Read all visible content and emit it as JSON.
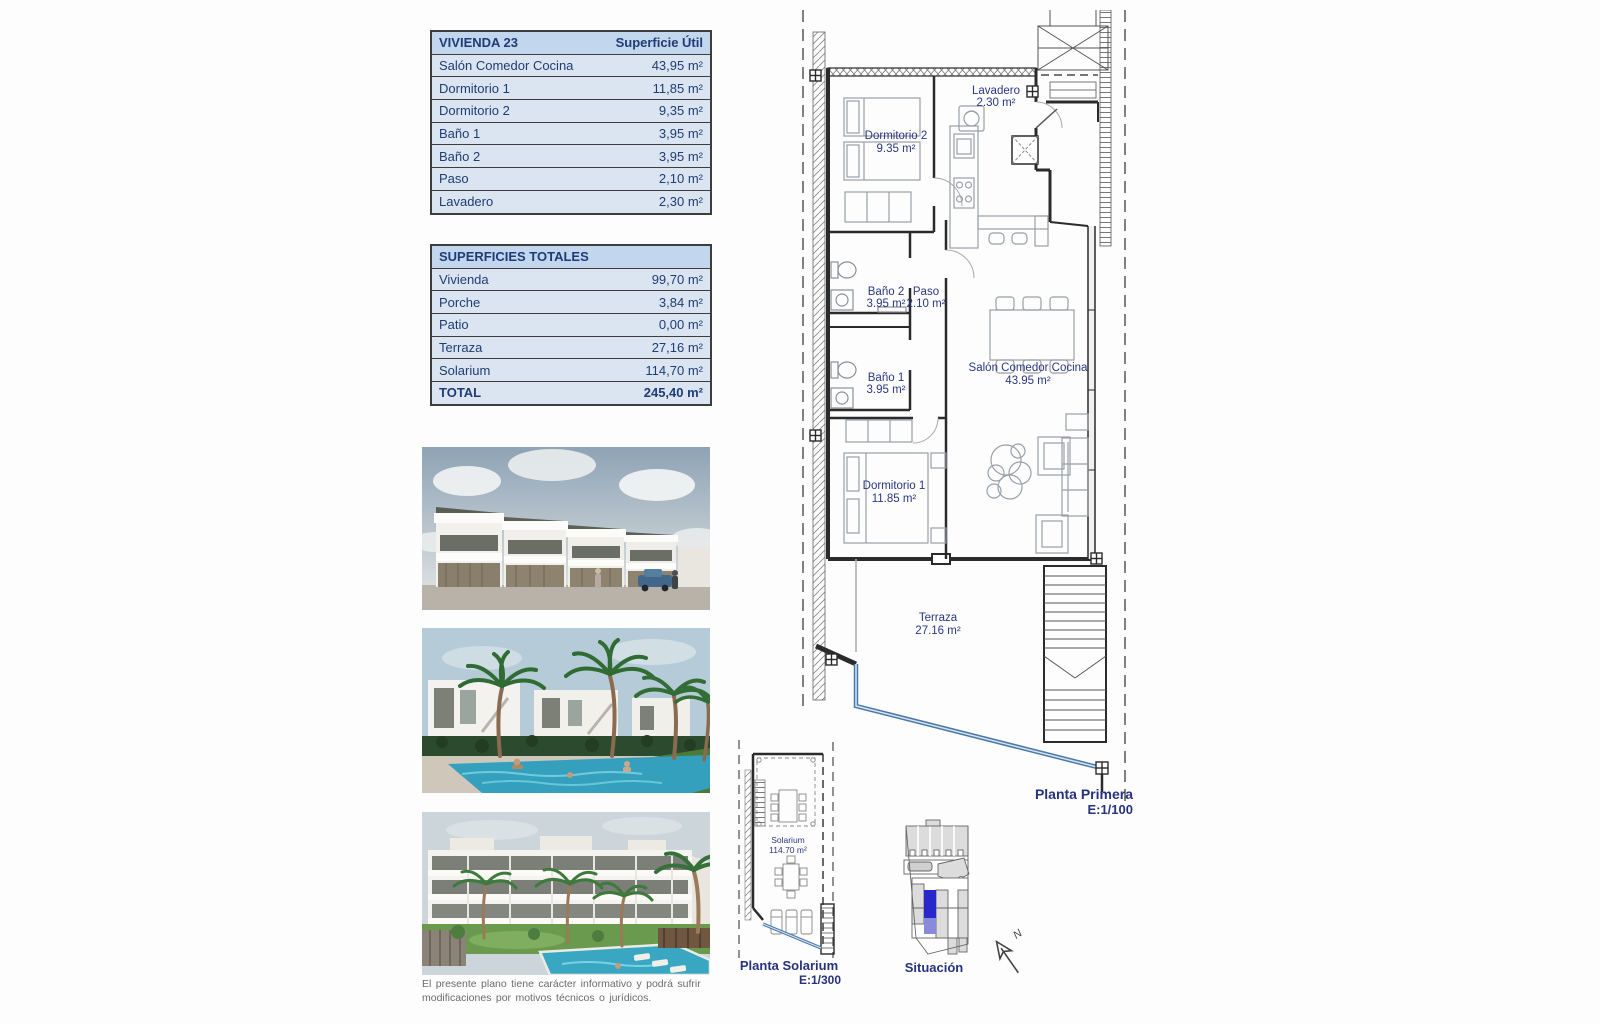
{
  "vivienda_table": {
    "title": "VIVIENDA 23",
    "header_value": "Superficie Útil",
    "rows": [
      {
        "label": "Salón Comedor Cocina",
        "value": "43,95 m²"
      },
      {
        "label": "Dormitorio 1",
        "value": "11,85 m²"
      },
      {
        "label": "Dormitorio 2",
        "value": "9,35 m²"
      },
      {
        "label": "Baño 1",
        "value": "3,95 m²"
      },
      {
        "label": "Baño 2",
        "value": "3,95 m²"
      },
      {
        "label": "Paso",
        "value": "2,10 m²"
      },
      {
        "label": "Lavadero",
        "value": "2,30 m²"
      }
    ]
  },
  "totales_table": {
    "title": "SUPERFICIES TOTALES",
    "rows": [
      {
        "label": "Vivienda",
        "value": "99,70 m²"
      },
      {
        "label": "Porche",
        "value": "3,84 m²"
      },
      {
        "label": "Patio",
        "value": "0,00 m²"
      },
      {
        "label": "Terraza",
        "value": "27,16 m²"
      },
      {
        "label": "Solarium",
        "value": "114,70 m²"
      }
    ],
    "total": {
      "label": "TOTAL",
      "value": "245,40 m²"
    }
  },
  "floor_plan": {
    "caption": "Planta Primera",
    "scale": "E:1/100",
    "rooms": {
      "dormitorio2": {
        "name": "Dormitorio 2",
        "area": "9.35 m²"
      },
      "lavadero": {
        "name": "Lavadero",
        "area": "2.30 m²"
      },
      "bano2": {
        "name": "Baño 2",
        "area": "3.95 m²"
      },
      "paso": {
        "name": "Paso",
        "area": "2.10 m²"
      },
      "bano1": {
        "name": "Baño 1",
        "area": "3.95 m²"
      },
      "salon": {
        "name": "Salón Comedor Cocina",
        "area": "43.95 m²"
      },
      "dormitorio1": {
        "name": "Dormitorio 1",
        "area": "11.85 m²"
      },
      "terraza": {
        "name": "Terraza",
        "area": "27.16 m²"
      }
    }
  },
  "solarium_plan": {
    "caption": "Planta Solarium",
    "scale": "E:1/300",
    "room": {
      "name": "Solarium",
      "area": "114.70 m²"
    }
  },
  "situacion": {
    "caption": "Situación",
    "north_label": "N"
  },
  "disclaimer": {
    "line1": "El presente plano tiene carácter informativo y podrá sufrir",
    "line2": "modificaciones por motivos técnicos o jurídicos."
  },
  "colors": {
    "accent_navy": "#26327e",
    "table_text": "#1f3c74",
    "table_header_bg": "#c2d6ee",
    "table_row_bg": "#dbe5f1",
    "plan_railing_blue": "#4a7aa8",
    "situacion_highlight_blue": "#2727cc"
  }
}
